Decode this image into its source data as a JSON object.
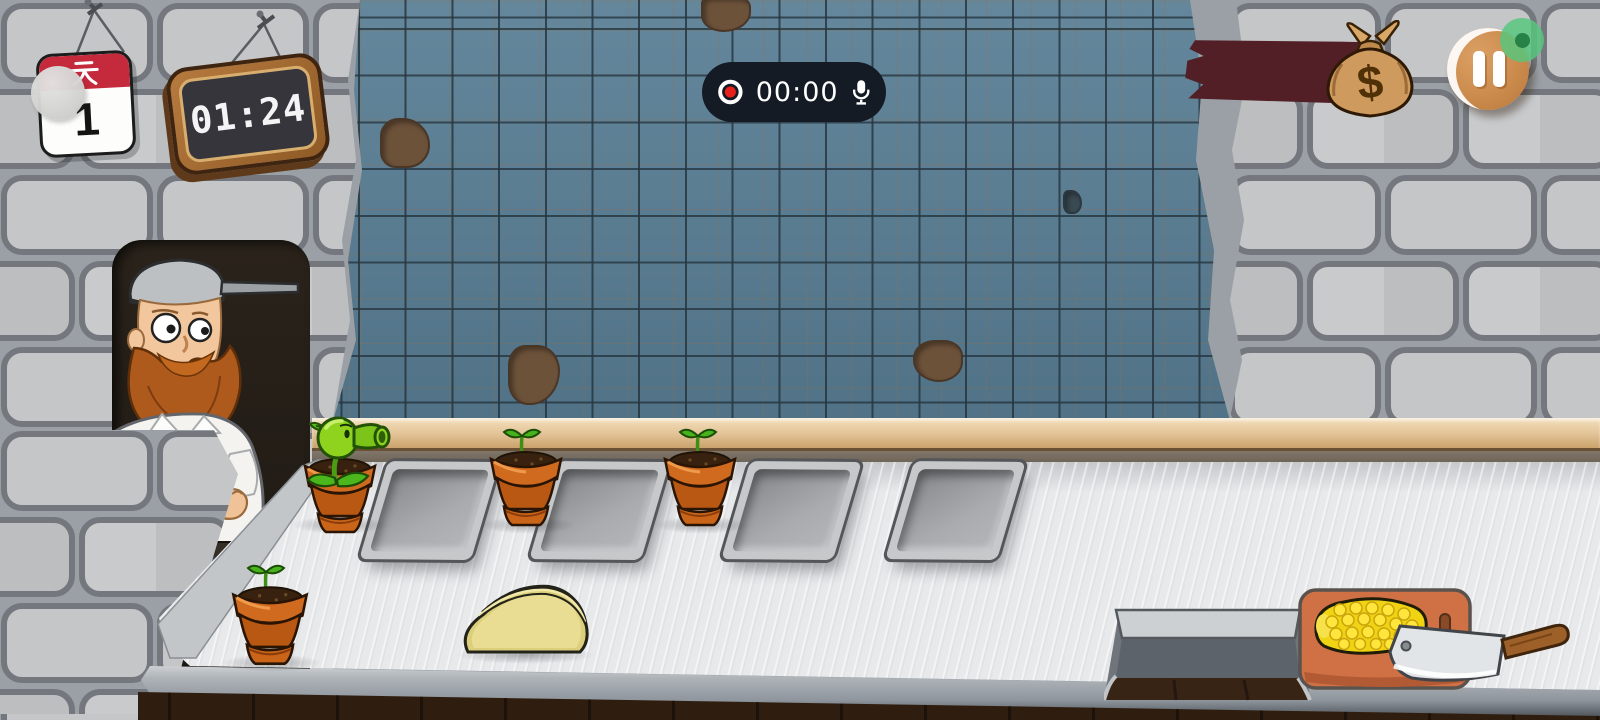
{
  "hud": {
    "calendar": {
      "header": "天",
      "day": "1"
    },
    "timer_sign": {
      "time": "01:24"
    },
    "recorder": {
      "elapsed": "00:00"
    },
    "money": {
      "symbol": "$"
    }
  },
  "scene": {
    "back_row_pots": 3,
    "front_row_pots": 1,
    "trays": 4,
    "plants": {
      "peashooter": 1,
      "seedlings": 3
    }
  },
  "colors": {
    "tile_blue": "#597e95",
    "stone_gray": "#c2c4c6",
    "counter_gray": "#e8e9eb",
    "banner_maroon": "#521f26",
    "pause_button_tan": "#cb8b4d",
    "record_red": "#e8211d",
    "recorder_pill": "#141b25",
    "pot_terracotta": "#d0691f",
    "plant_green": "#8fd31f",
    "cutting_board_orange": "#cf7045",
    "corn_yellow": "#f3d714",
    "dough_tan": "#dccf7c",
    "wood_floor_brown": "#2f1e10"
  }
}
